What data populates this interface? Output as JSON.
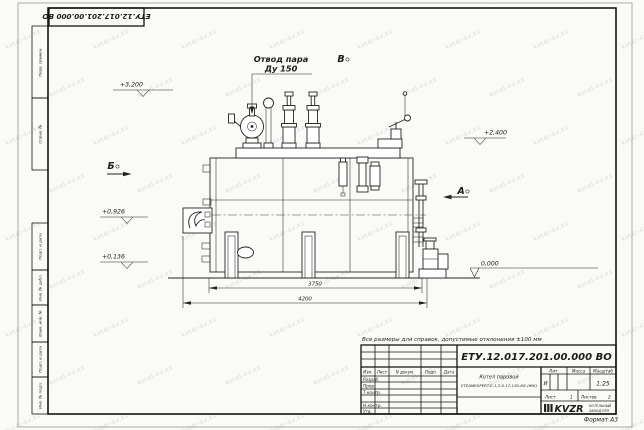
{
  "sheet": {
    "doc_number_top": "ЕТУ.12.017.201.00.000  ВО",
    "format": "Формат А3",
    "note": "Все размеры для справок, допустимые отклонения ±100 мм"
  },
  "margin": {
    "perv_primen": "Перв. примен.",
    "sprav_no": "Справ. №",
    "podp_data_1": "Подп. и дата",
    "inv_dubl": "Инв. № дубл.",
    "vzam_inv": "Взам. инв. №",
    "podp_data_2": "Подп. и дата",
    "inv_podl": "Инв. № подл."
  },
  "drawing": {
    "steam_outlet_label": "Отвод пара",
    "steam_outlet_dn": "Ду 150",
    "view_a": "А",
    "view_b": "Б",
    "view_v": "В",
    "elev_top": "+3,200",
    "elev_right": "+2,400",
    "elev_burner": "+0,926",
    "elev_low": "+0,136",
    "elev_zero": "0,000",
    "dim_span": "3750",
    "dim_overall": "4200"
  },
  "title_block": {
    "doc_number": "ЕТУ.12.017.201.00.000  ВО",
    "name_line1": "Котел паровой",
    "name_line2": "STEAMEXPERT-Е-1,2-0,17-130-КБ (ЖК)",
    "col_izm": "Изм.",
    "col_list": "Лист",
    "col_ndokum": "N докум.",
    "col_podp": "Подп.",
    "col_data": "Дата",
    "row_razrab": "Разраб.",
    "row_prov": "Пров.",
    "row_tkontr": "Т.контр.",
    "row_nkontr": "Н.контр.",
    "row_utv": "Утв.",
    "hdr_lit": "Лит.",
    "hdr_massa": "Масса",
    "hdr_masshtab": "Масштаб",
    "lit_value": "И",
    "scale": "1:25",
    "list_label": "Лист",
    "list_value": "1",
    "listov_label": "Листов",
    "listov_value": "2",
    "logo": "KVZR",
    "company_line1": "КОТЕЛЬНЫЙ",
    "company_line2": "ЗАВОД РЭП"
  },
  "watermark": {
    "text": "kotel-kv.kz"
  }
}
